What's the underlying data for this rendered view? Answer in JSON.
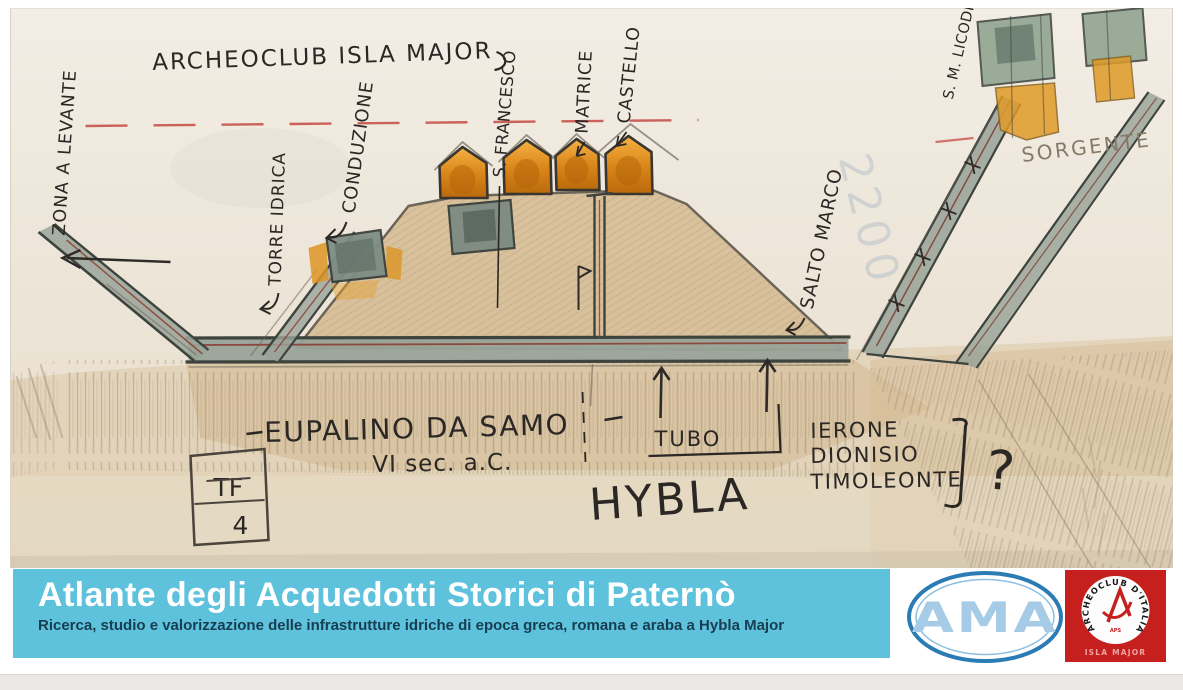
{
  "sketch": {
    "header": "ARCHEOCLUB ISLA MAJOR",
    "labels": {
      "zona": "ZONA A LEVANTE",
      "torre_idrica": "TORRE IDRICA",
      "conduzione": "CONDUZIONE",
      "san_francesco": "S. FRANCESCO",
      "matrice": "MATRICE",
      "castello": "CASTELLO",
      "salto_marco": "SALTO MARCO",
      "s_m_licodia": "S. M. LICODIA",
      "sorgente": "SORGENTE",
      "eupalino": "EUPALINO DA SAMO",
      "eupalino_epoca": "VI sec. a.C.",
      "tubo": "TUBO",
      "hybla": "HYBLA",
      "tiranni": [
        "IERONE",
        "DIONISIO",
        "TIMOLEONTE"
      ],
      "question": "?",
      "sigla": [
        "TF",
        "4"
      ],
      "filigrana": "2200"
    },
    "colors": {
      "red_dashed_line": "#c24038",
      "water_channel": "#95a095",
      "hut_orange": "#e09b28",
      "ground_tan": "#d6bd95",
      "paper": "#ece4d6"
    }
  },
  "banner": {
    "title": "Atlante degli Acquedotti Storici di Paternò",
    "subtitle": "Ricerca, studio e valorizzazione delle infrastrutture idriche di epoca greca, romana e araba a Hybla Major",
    "background_color": "#5fc2dd"
  },
  "logos": {
    "ama": {
      "text": "AMA",
      "ring_color": "#2b7cb4",
      "letter_color": "#a5cbe7"
    },
    "archeoclub": {
      "arc_text": "ARCHEOCLUB D'ITALIA",
      "aps": "APS",
      "bottom": "ISLA MAJOR",
      "background_color": "#c6201e"
    }
  }
}
